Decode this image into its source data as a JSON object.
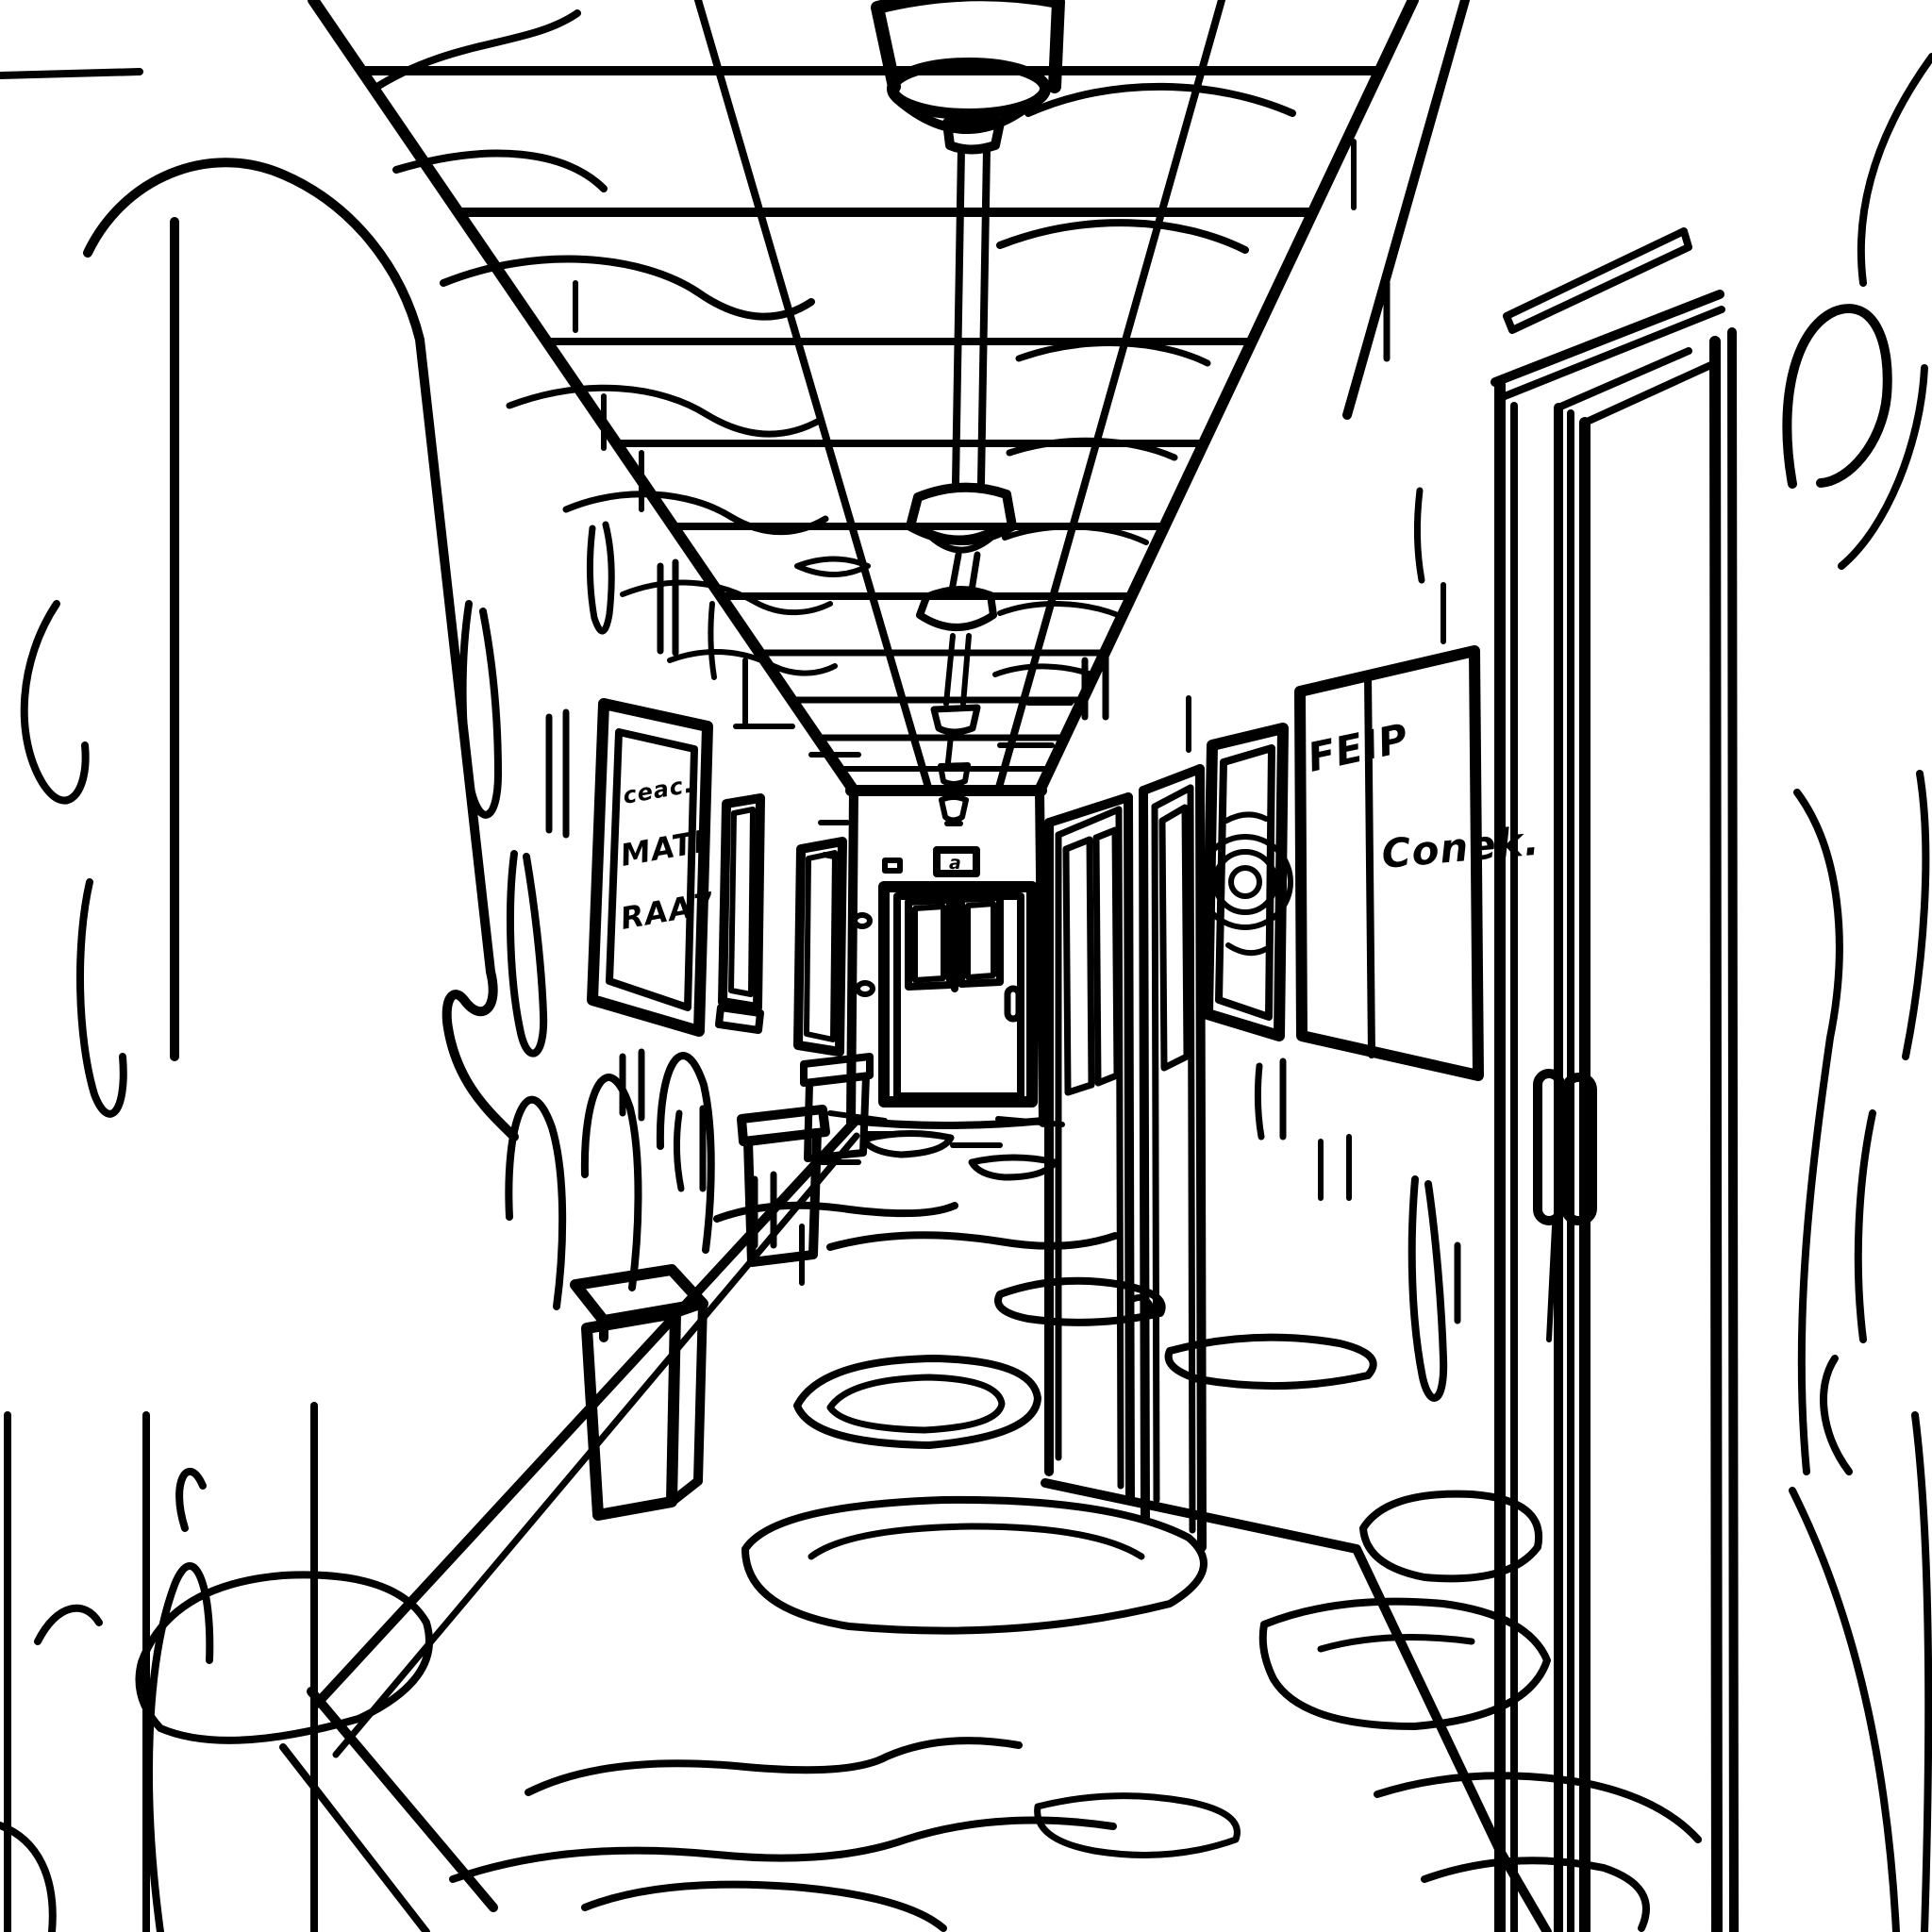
{
  "scene": {
    "kind": "coloring-book line-art hallway",
    "perspective": "one-point"
  },
  "colors": {
    "ink": "#000000",
    "paper": "#ffffff"
  },
  "texts": {
    "poster_line1": "ceac.",
    "poster_line2": "MATI",
    "poster_line3": "RAA7",
    "whiteboard_top": "FEIP",
    "whiteboard_note": "Conek.",
    "exit_sign": "a"
  },
  "objects": [
    "ceiling-grid",
    "pendant-lights",
    "end-wall",
    "end-door",
    "exit-sign",
    "left-wall",
    "left-wall-poster",
    "left-wall-window-frames",
    "trash-cans",
    "right-wall",
    "right-wall-far-doors",
    "round-picture-frame",
    "whiteboard-sign",
    "foreground-door",
    "door-handles",
    "carpet-swirls",
    "wall-drips",
    "foreground-swirls"
  ]
}
